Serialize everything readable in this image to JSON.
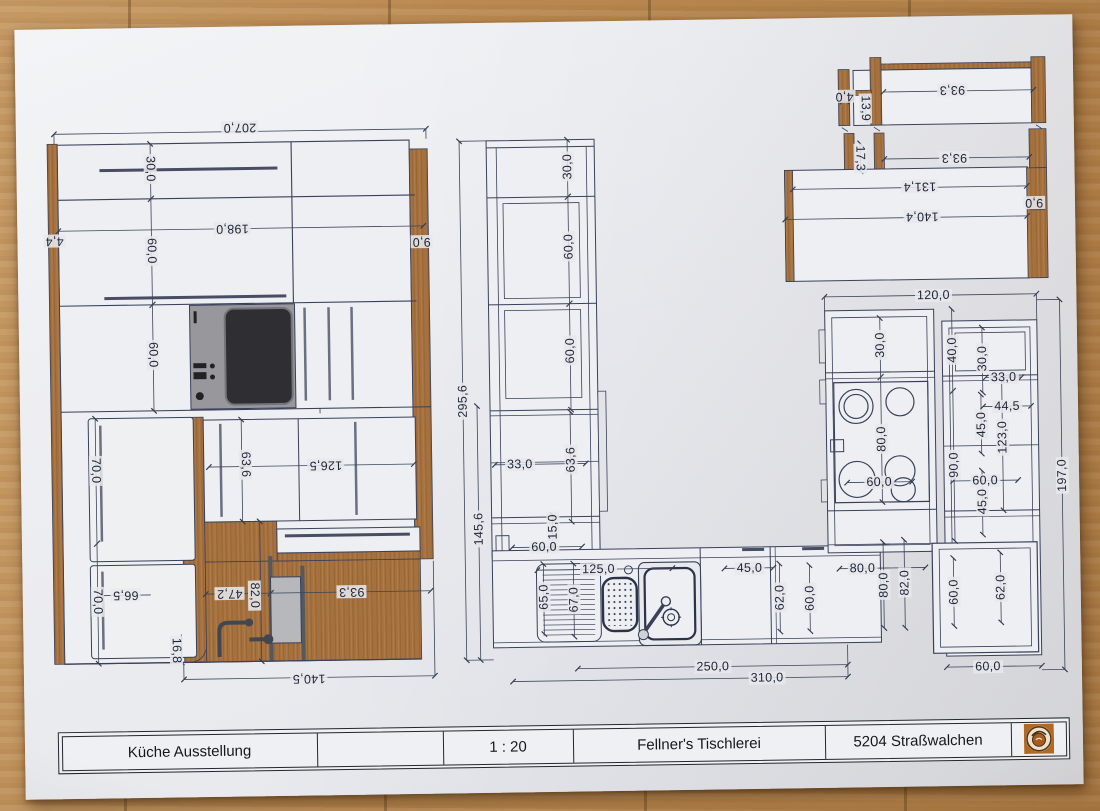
{
  "title_block": {
    "project": "Küche Ausstellung",
    "empty_cell": "",
    "scale": "1 : 20",
    "company": "Fellner's Tischlerei",
    "location": "5204 Straßwalchen",
    "logo": "fellner-stamp-logo"
  },
  "left_elevation": {
    "dims": {
      "d207": "207,0",
      "d198": "198,0",
      "d30": "30,0",
      "d60a": "60,0",
      "d60b": "60,0",
      "d44": "4,4",
      "d9": "9,0",
      "d70a": "70,0",
      "d636": "63,6",
      "d1265": "126,5",
      "d70b": "70,0",
      "d665": "66,5",
      "d472": "47,2",
      "d82": "82,0",
      "d933": "93,3",
      "d168": "16,8",
      "d1405": "140,5"
    }
  },
  "floor_plan": {
    "dims": {
      "d2956": "295,6",
      "d1456": "145,6",
      "d30a": "30,0",
      "d60a": "60,0",
      "d60b": "60,0",
      "d33a": "33,0",
      "d636": "63,6",
      "d15": "15,0",
      "d60c": "60,0",
      "d125": "125,0",
      "d65": "65,0",
      "d67": "67,0",
      "d45a": "45,0",
      "d62a": "62,0",
      "d60d": "60,0",
      "d250": "250,0",
      "d310": "310,0",
      "d80a": "80,0",
      "d80b": "80,0",
      "d82": "82,0",
      "d120": "120,0",
      "d30b": "30,0",
      "d40": "40,0",
      "d30c": "30,0",
      "d33b": "33,0",
      "d445": "44,5",
      "d45b": "45,0",
      "d123": "123,0",
      "d80c": "80,0",
      "d90": "90,0",
      "d60e": "60,0",
      "d60f": "60,0",
      "d45c": "45,0",
      "d197": "197,0",
      "d60g": "60,0",
      "d62b": "62,0",
      "d60h": "60,0"
    }
  },
  "corner_detail": {
    "dims": {
      "d933a": "93,3",
      "d40": "4,0",
      "d139": "13,9",
      "d173": "17,3",
      "d933b": "93,3",
      "d1314": "131,4",
      "d90": "9,0",
      "d1404": "140,4"
    }
  },
  "colors": {
    "paper": "#e8e9ed",
    "wood_table": "#bb8a52",
    "drawing_wood": "#a5713f",
    "line": "#39405a",
    "logo_accent": "#b06a24"
  }
}
